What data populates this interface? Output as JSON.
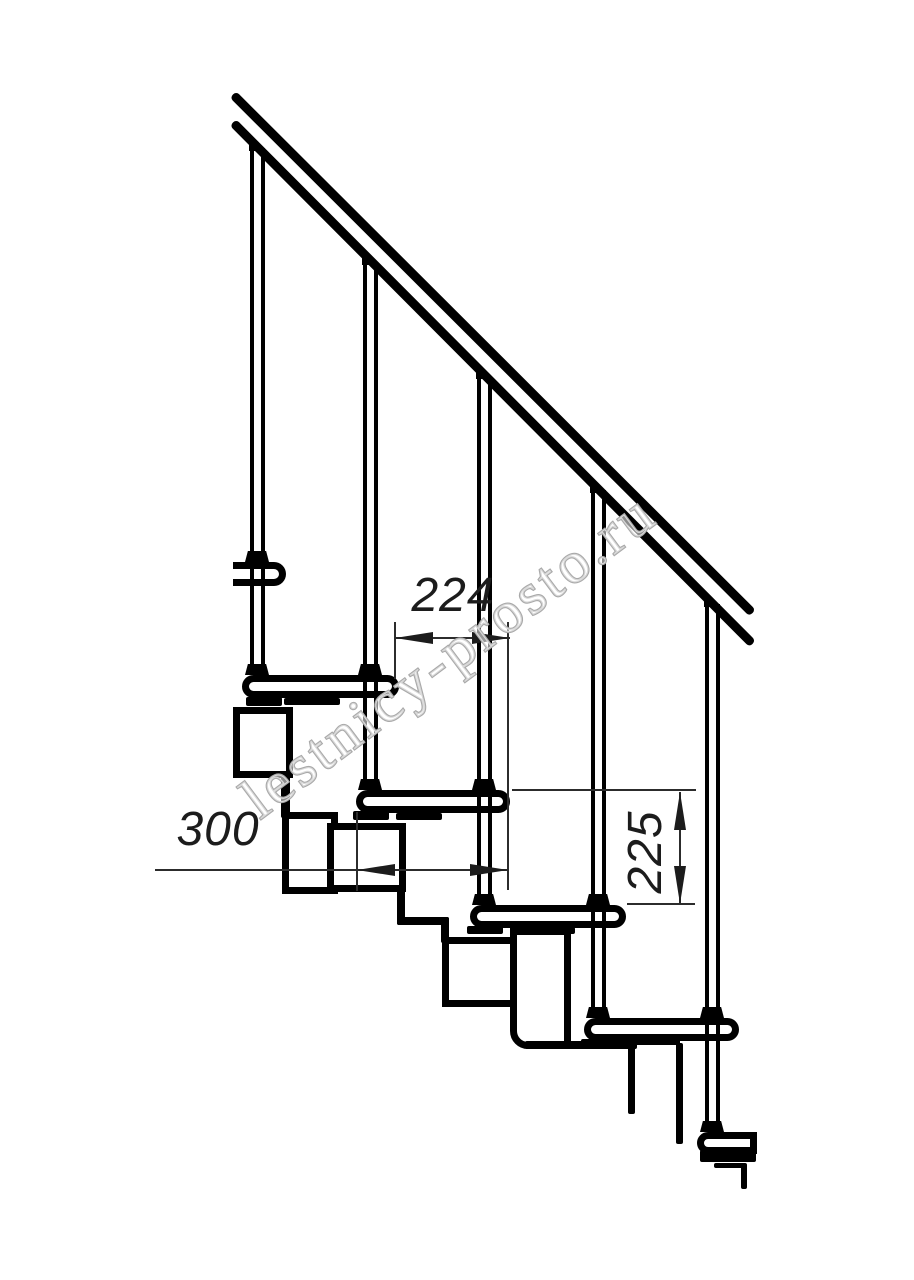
{
  "canvas": {
    "background": "#ffffff",
    "line_color": "#000000",
    "dimension_color": "#2c2c2c"
  },
  "dimensions": {
    "going": "224",
    "tread_depth": "300",
    "rise": "225"
  },
  "watermark": {
    "text": "lestnicy-prosto.ru",
    "color": "#a9a9a9"
  },
  "structure": {
    "handrail_lines": 2,
    "balusters": 5,
    "treads": 6
  }
}
